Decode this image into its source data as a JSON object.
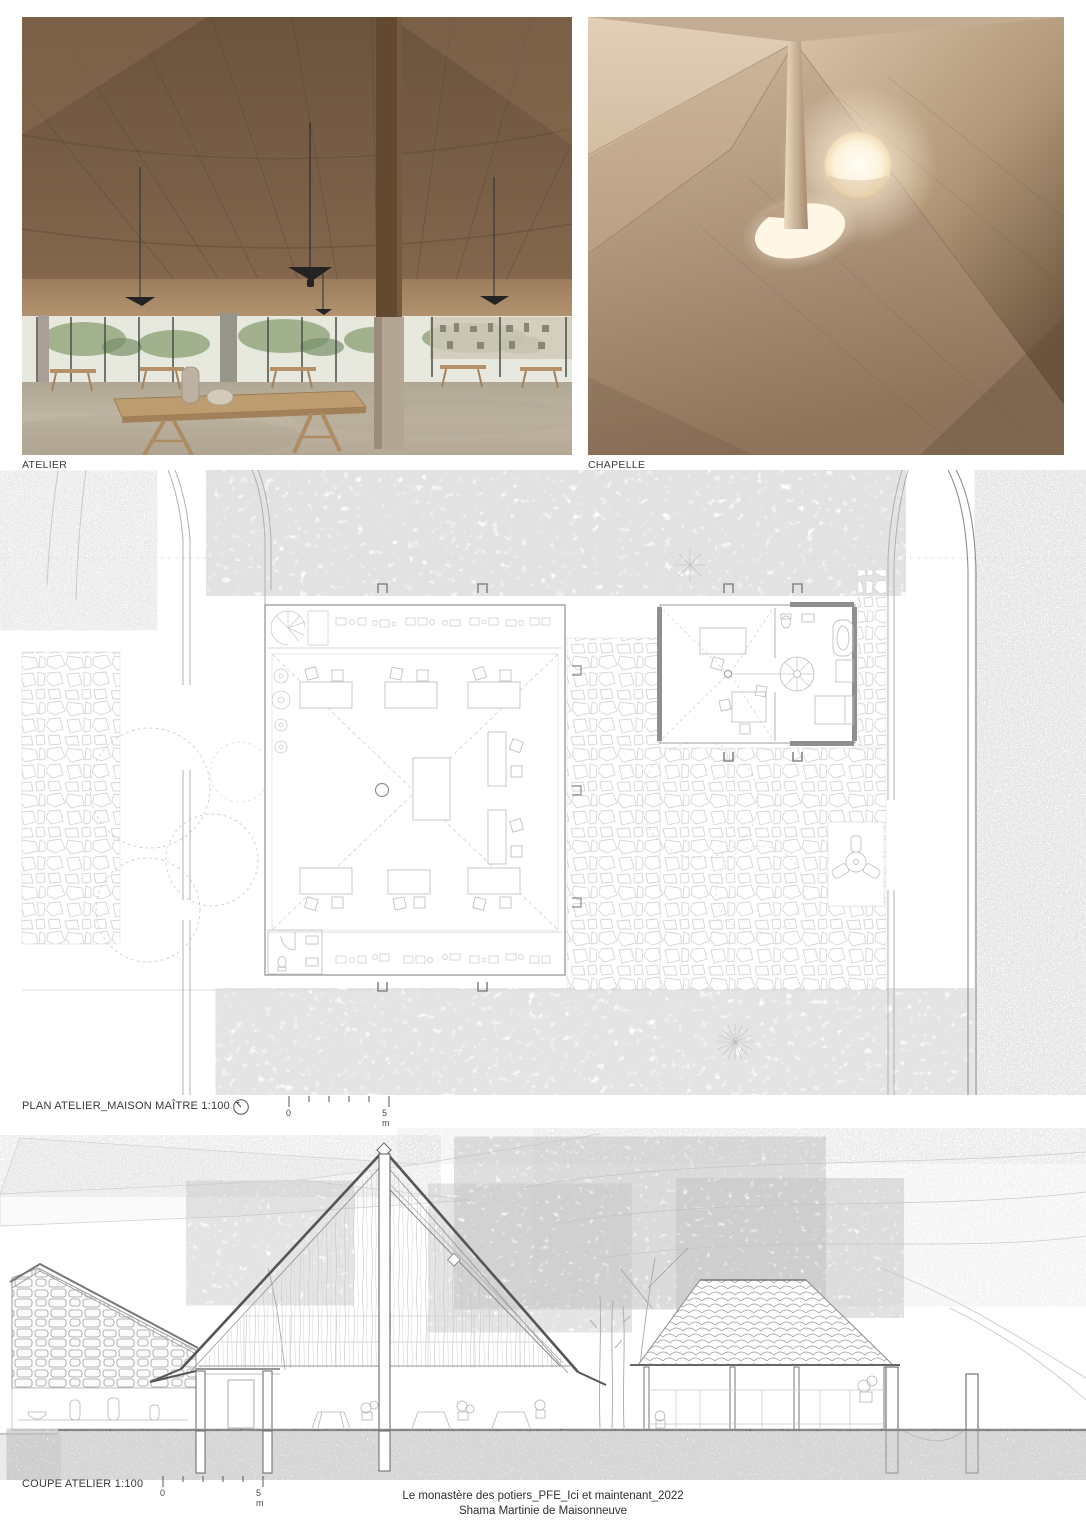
{
  "figures": {
    "atelier": {
      "caption": "ATELIER"
    },
    "chapelle": {
      "caption": "CHAPELLE"
    },
    "plan": {
      "caption": "PLAN ATELIER_MAISON MAÎTRE 1:100",
      "scale": {
        "zero": "0",
        "five": "5 m"
      }
    },
    "coupe": {
      "caption": "COUPE ATELIER 1:100",
      "scale": {
        "zero": "0",
        "five": "5 m"
      }
    }
  },
  "footer": {
    "line1": "Le monastère des potiers_PFE_Ici et maintenant_2022",
    "line2": "Shama Martinie de Maisonneuve"
  },
  "palette": {
    "ceiling_wood_dark": "#6a523c",
    "ceiling_wood_mid": "#7c6249",
    "fascia_wood": "#c2a178",
    "plaster_light": "#dfccb3",
    "plaster_mid": "#c5ae94",
    "plaster_dark": "#77604a",
    "oculus_glow": "#fff6e4",
    "floor_concrete": "#b5aa99",
    "foliage_green": "#8da076",
    "drawing_line_light": "#cccccc",
    "drawing_line_mid": "#9a9a9a",
    "ink": "#3a3a3a",
    "paper": "#ffffff"
  }
}
